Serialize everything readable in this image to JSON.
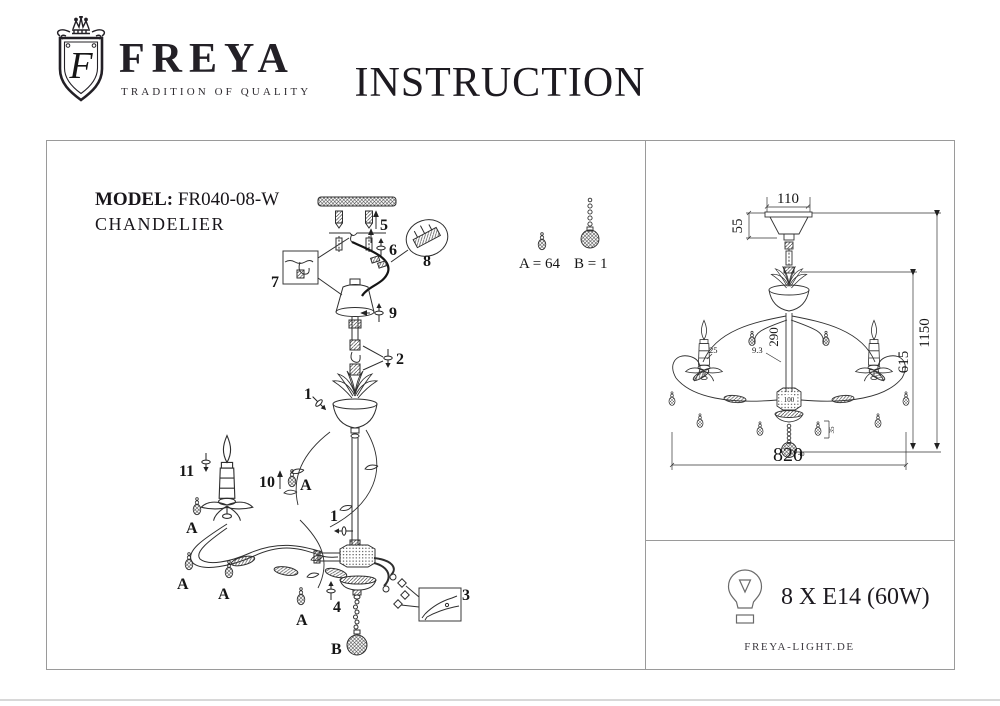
{
  "brand": {
    "name": "FREYA",
    "tagline": "TRADITION OF QUALITY",
    "monogram": "F"
  },
  "title": "INSTRUCTION",
  "model": {
    "label": "MODEL:",
    "number": "FR040-08-W",
    "type": "CHANDELIER"
  },
  "assembly": {
    "steps": {
      "s1": "1",
      "s2": "2",
      "s3": "3",
      "s4": "4",
      "s5": "5",
      "s6": "6",
      "s7": "7",
      "s8": "8",
      "s9": "9",
      "s10": "10",
      "s11": "11"
    },
    "crystal_a": "A",
    "crystal_b": "B",
    "legend": {
      "a": "A = 64",
      "b": "B = 1"
    }
  },
  "dimensions": {
    "canopy_width": "110",
    "canopy_height": "55",
    "rod_length": "290",
    "leaf_size": "9.3",
    "candle_dia": "25",
    "hub_dia": "100",
    "pendant_size": "35",
    "ball_size": "40",
    "body_height": "615",
    "total_height": "1150",
    "total_width": "820"
  },
  "specs": {
    "bulbs": "8 X E14 (60W)"
  },
  "footer": {
    "website": "FREYA-LIGHT.DE"
  },
  "colors": {
    "ink": "#1b1b1b",
    "line": "#2e2e2e",
    "border": "#9a9a9a"
  }
}
